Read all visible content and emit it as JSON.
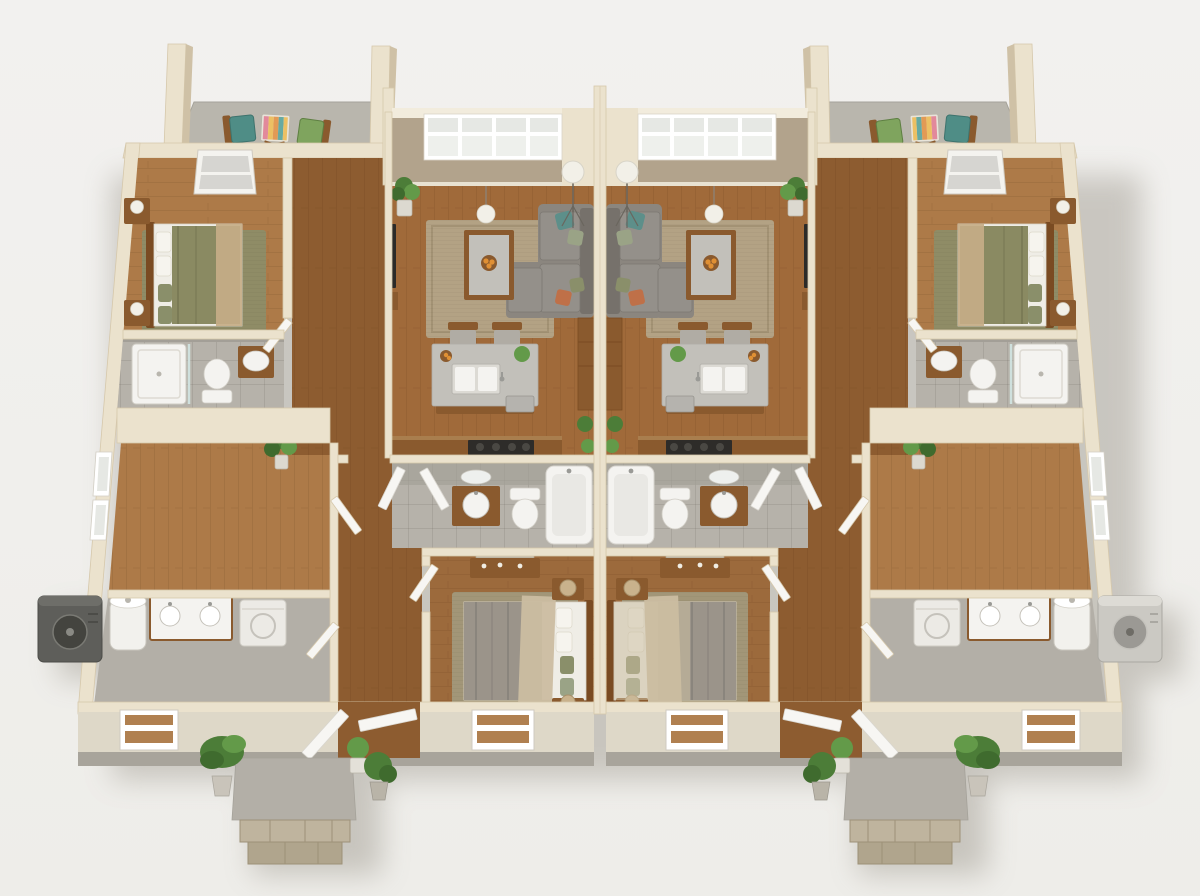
{
  "scene": {
    "type": "architectural-3d-floor-plan-render",
    "view": "isometric-top-down",
    "building": "mirrored-duplex",
    "unit_count": 2,
    "visible_text": "none"
  },
  "palette": {
    "bg": "#f1f0ed",
    "shadow": "#8a8478",
    "wall_cream": "#ebe2cd",
    "wall_edge": "#d6c8ab",
    "wall_face": "#ded8c8",
    "wall_base": "#a8a49b",
    "wall_tan": "#b2a38c",
    "wall_cap": "#f2ecdd",
    "wood_living": "#a06a3a",
    "wood_bedroom": "#ad7a48",
    "wood_hall": "#8d5c30",
    "wood_center_bed": "#9c6a3c",
    "tile": "#b6b2aa",
    "tile_wall": "#a39f97",
    "concrete": "#b3afa7",
    "patio": "#b9b6ad",
    "rug_living": "#b3a284",
    "rug_olive": "#8f8c66",
    "rug_center": "#a29678",
    "sofa": "#8b867f",
    "sofa_dark": "#76716b",
    "sofa_seat": "#94908a",
    "wood_furniture": "#8a5a2e",
    "wood_dark": "#7a4b22",
    "counter": "#c2c0ba",
    "white_fixture": "#f4f3f0",
    "fixture_inner": "#e9e8e4",
    "duvet_olive": "#8a8a62",
    "duvet_gray": "#9b948a",
    "sheet": "#efede6",
    "throw_tan": "#c5ad87",
    "throw_beige": "#cbbda1",
    "pillow_teal": "#5d8f8a",
    "pillow_sage": "#9aa386",
    "pillow_rust": "#bf7048",
    "pillow_olive": "#8a8f6a",
    "plant_dark": "#3f6b2e",
    "plant_mid": "#4c7d38",
    "plant_light": "#639a49",
    "stone": "#bfb49e",
    "stone_dark": "#b0a58d",
    "ac_dark": "#5e5e5a",
    "ac_dark_fan": "#44443f",
    "ac_light": "#cbc9c3",
    "ac_light_fan": "#9b9994",
    "tv": "#2b2a28",
    "cooktop": "#2e2c29",
    "lamp": "#f2f0e8",
    "window_glass": "#e6e8e4",
    "glass_dark": "#d6d5d1",
    "chair_teal": "#4f8d86",
    "table_pink": "#e2899b",
    "table_yellow": "#ecc064",
    "table_orange": "#e29a55",
    "table_teal": "#67aaa2",
    "orange_fruit": "#e09034",
    "heater": "#f2f1ed",
    "washer": "#eceae5",
    "door": "#f7f6f3"
  },
  "units": [
    {
      "id": "unit-a",
      "side": "left",
      "rooms": [
        {
          "name": "bedroom-front",
          "objects": [
            "bed-olive-bedding",
            "nightstand-with-lamp",
            "nightstand-with-lamp",
            "area-rug-olive",
            "skylight-window"
          ]
        },
        {
          "name": "bathroom-front",
          "objects": [
            "walk-in-shower",
            "toilet",
            "vanity-sink"
          ]
        },
        {
          "name": "flex-room",
          "objects": [
            "potted-plant",
            "side-wall-windows"
          ]
        },
        {
          "name": "utility-room",
          "objects": [
            "water-heater",
            "double-sink-vanity",
            "washer"
          ]
        },
        {
          "name": "living-room",
          "objects": [
            "sectional-sofa",
            "throw-pillows",
            "coffee-table",
            "fruit-bowl",
            "area-rug-tan",
            "pendant-lamp",
            "tripod-floor-lamp",
            "wall-tv",
            "media-console",
            "potted-plant",
            "transom-window-band",
            "dining-chairs",
            "tall-cabinet"
          ]
        },
        {
          "name": "kitchen",
          "objects": [
            "island-with-double-sink",
            "dishwasher",
            "cooktop-counter",
            "bar-chairs",
            "herb-plant",
            "fruit-bowl"
          ]
        },
        {
          "name": "bathroom-center",
          "objects": [
            "oval-mirror",
            "vanity-sink",
            "toilet",
            "bathtub",
            "entry-doors"
          ]
        },
        {
          "name": "bedroom-center",
          "objects": [
            "bed-gray-striped-bedding",
            "dresser-with-mirror",
            "nightstand-woven-lamp",
            "nightstand-woven-lamp",
            "area-rug",
            "rear-window"
          ]
        }
      ],
      "exterior": [
        "roof-patio",
        "patio-chairs",
        "striped-side-table",
        "masonry-pillars",
        "front-porch-stone-steps",
        "landscape-plants",
        "ac-condenser-dark",
        "front-doors-open",
        "utility-window",
        "bedroom-window"
      ]
    },
    {
      "id": "unit-b",
      "side": "right",
      "mirror_of": "unit-a",
      "differences": [
        "bed-center-beige-bedding",
        "ac-condenser-light"
      ]
    }
  ]
}
